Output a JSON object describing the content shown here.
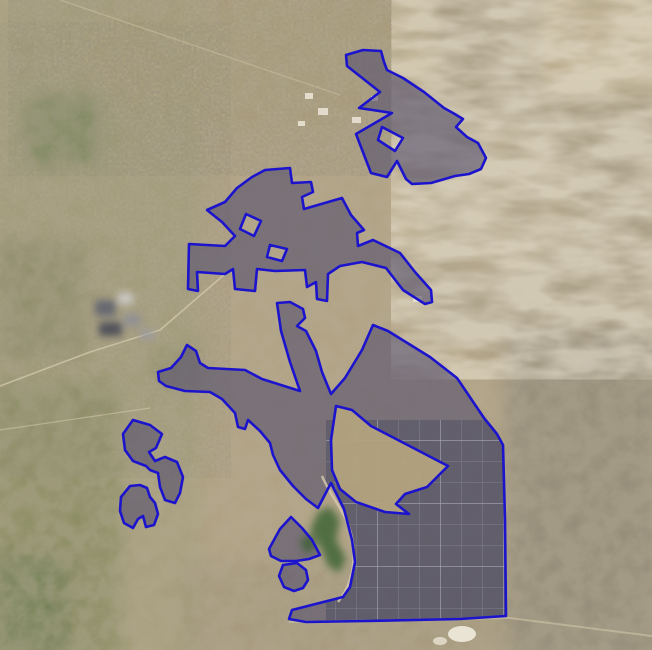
{
  "map": {
    "kind": "satellite-imagery-with-parcel-overlays",
    "canvas": {
      "width": 652,
      "height": 650
    },
    "overlay": {
      "stroke_color": "#1c13cd",
      "stroke_width": 2.6,
      "fill_color": "#57526e",
      "fill_opacity": 0.62,
      "cutout_fill_color": "#b3a37e",
      "panel_block_tint": "#2e3452",
      "panel_grid_line_color": "#b8bcd2",
      "polygons": [
        {
          "id": "site-north",
          "points": [
            [
              346,
              55
            ],
            [
              363,
              50
            ],
            [
              381,
              51
            ],
            [
              384,
              62
            ],
            [
              387,
              70
            ],
            [
              403,
              78
            ],
            [
              424,
              92
            ],
            [
              444,
              108
            ],
            [
              453,
              113
            ],
            [
              463,
              119
            ],
            [
              456,
              127
            ],
            [
              467,
              137
            ],
            [
              478,
              143
            ],
            [
              486,
              158
            ],
            [
              481,
              169
            ],
            [
              469,
              174
            ],
            [
              455,
              176
            ],
            [
              431,
              183
            ],
            [
              412,
              184
            ],
            [
              406,
              179
            ],
            [
              397,
              161
            ],
            [
              387,
              177
            ],
            [
              371,
              173
            ],
            [
              356,
              134
            ],
            [
              392,
              113
            ],
            [
              359,
              108
            ],
            [
              380,
              92
            ],
            [
              347,
              66
            ]
          ],
          "holes": [
            [
              [
                382,
                127
              ],
              [
                403,
                138
              ],
              [
                395,
                151
              ],
              [
                378,
                140
              ]
            ]
          ]
        },
        {
          "id": "site-middle",
          "points": [
            [
              252,
              177
            ],
            [
              265,
              170
            ],
            [
              290,
              168
            ],
            [
              292,
              183
            ],
            [
              311,
              182
            ],
            [
              313,
              192
            ],
            [
              302,
              197
            ],
            [
              304,
              209
            ],
            [
              342,
              198
            ],
            [
              351,
              215
            ],
            [
              364,
              230
            ],
            [
              357,
              233
            ],
            [
              358,
              246
            ],
            [
              373,
              240
            ],
            [
              400,
              253
            ],
            [
              415,
              272
            ],
            [
              431,
              290
            ],
            [
              432,
              302
            ],
            [
              425,
              304
            ],
            [
              403,
              290
            ],
            [
              386,
              268
            ],
            [
              362,
              262
            ],
            [
              340,
              266
            ],
            [
              328,
              274
            ],
            [
              327,
              301
            ],
            [
              317,
              299
            ],
            [
              316,
              282
            ],
            [
              307,
              287
            ],
            [
              305,
              270
            ],
            [
              275,
              271
            ],
            [
              257,
              269
            ],
            [
              255,
              291
            ],
            [
              235,
              289
            ],
            [
              233,
              269
            ],
            [
              225,
              274
            ],
            [
              197,
              272
            ],
            [
              198,
              291
            ],
            [
              188,
              289
            ],
            [
              189,
              244
            ],
            [
              225,
              246
            ],
            [
              235,
              236
            ],
            [
              222,
              222
            ],
            [
              207,
              210
            ],
            [
              225,
              202
            ],
            [
              237,
              188
            ]
          ],
          "holes": [
            [
              [
                246,
                214
              ],
              [
                261,
                221
              ],
              [
                254,
                236
              ],
              [
                240,
                229
              ]
            ],
            [
              [
                270,
                245
              ],
              [
                287,
                249
              ],
              [
                282,
                261
              ],
              [
                267,
                257
              ]
            ]
          ]
        },
        {
          "id": "site-main",
          "points": [
            [
              277,
              303
            ],
            [
              290,
              302
            ],
            [
              303,
              309
            ],
            [
              305,
              318
            ],
            [
              297,
              326
            ],
            [
              306,
              331
            ],
            [
              316,
              351
            ],
            [
              322,
              372
            ],
            [
              331,
              394
            ],
            [
              345,
              378
            ],
            [
              362,
              350
            ],
            [
              373,
              325
            ],
            [
              388,
              331
            ],
            [
              430,
              357
            ],
            [
              457,
              378
            ],
            [
              484,
              418
            ],
            [
              497,
              434
            ],
            [
              503,
              445
            ],
            [
              505,
              520
            ],
            [
              506,
              616
            ],
            [
              460,
              619
            ],
            [
              365,
              621
            ],
            [
              306,
              622
            ],
            [
              289,
              619
            ],
            [
              292,
              610
            ],
            [
              343,
              597
            ],
            [
              350,
              587
            ],
            [
              355,
              562
            ],
            [
              352,
              540
            ],
            [
              344,
              509
            ],
            [
              331,
              483
            ],
            [
              318,
              508
            ],
            [
              306,
              499
            ],
            [
              293,
              486
            ],
            [
              280,
              470
            ],
            [
              273,
              455
            ],
            [
              270,
              443
            ],
            [
              260,
              431
            ],
            [
              248,
              420
            ],
            [
              245,
              429
            ],
            [
              238,
              427
            ],
            [
              235,
              413
            ],
            [
              222,
              399
            ],
            [
              210,
              392
            ],
            [
              185,
              391
            ],
            [
              166,
              386
            ],
            [
              159,
              381
            ],
            [
              158,
              372
            ],
            [
              171,
              368
            ],
            [
              181,
              357
            ],
            [
              187,
              345
            ],
            [
              196,
              351
            ],
            [
              200,
              363
            ],
            [
              208,
              368
            ],
            [
              245,
              370
            ],
            [
              262,
              379
            ],
            [
              300,
              391
            ],
            [
              290,
              362
            ],
            [
              281,
              331
            ]
          ],
          "holes": []
        },
        {
          "id": "site-main-cutout",
          "cutout": true,
          "points": [
            [
              336,
              406
            ],
            [
              352,
              410
            ],
            [
              371,
              426
            ],
            [
              448,
              466
            ],
            [
              427,
              487
            ],
            [
              405,
              494
            ],
            [
              396,
              504
            ],
            [
              409,
              514
            ],
            [
              385,
              512
            ],
            [
              356,
              502
            ],
            [
              340,
              489
            ],
            [
              332,
              470
            ],
            [
              331,
              440
            ]
          ]
        },
        {
          "id": "site-west-upper",
          "points": [
            [
              133,
              420
            ],
            [
              150,
              425
            ],
            [
              162,
              434
            ],
            [
              156,
              448
            ],
            [
              149,
              452
            ],
            [
              155,
              461
            ],
            [
              165,
              457
            ],
            [
              177,
              462
            ],
            [
              183,
              477
            ],
            [
              180,
              493
            ],
            [
              175,
              503
            ],
            [
              165,
              500
            ],
            [
              160,
              487
            ],
            [
              158,
              473
            ],
            [
              150,
              470
            ],
            [
              146,
              466
            ],
            [
              133,
              461
            ],
            [
              125,
              450
            ],
            [
              123,
              434
            ]
          ]
        },
        {
          "id": "site-west-lower",
          "points": [
            [
              121,
              497
            ],
            [
              130,
              486
            ],
            [
              140,
              485
            ],
            [
              147,
              488
            ],
            [
              150,
              497
            ],
            [
              155,
              503
            ],
            [
              158,
              514
            ],
            [
              154,
              525
            ],
            [
              146,
              527
            ],
            [
              143,
              516
            ],
            [
              138,
              519
            ],
            [
              133,
              528
            ],
            [
              124,
              523
            ],
            [
              120,
              511
            ]
          ]
        },
        {
          "id": "site-south-triangle",
          "points": [
            [
              269,
              549
            ],
            [
              280,
              529
            ],
            [
              291,
              517
            ],
            [
              302,
              528
            ],
            [
              312,
              540
            ],
            [
              320,
              555
            ],
            [
              309,
              559
            ],
            [
              296,
              561
            ],
            [
              281,
              561
            ],
            [
              271,
              556
            ]
          ]
        },
        {
          "id": "site-south-small",
          "points": [
            [
              283,
              565
            ],
            [
              297,
              563
            ],
            [
              306,
              570
            ],
            [
              308,
              580
            ],
            [
              303,
              588
            ],
            [
              294,
              591
            ],
            [
              284,
              587
            ],
            [
              279,
              576
            ]
          ]
        }
      ]
    },
    "terrain": {
      "base_color": "#b2a283",
      "farmland_olive": "#7d7f58",
      "field_green": "#5d7a44",
      "bottomleft_green": "#75804f",
      "ridge_tan": "#a89d87",
      "plain_gray": "#8d8675",
      "pale_wash": "#c6b794",
      "vegetation_green": "#47683a",
      "road_color": "#d8cbae",
      "building_white": "#e9e3d4",
      "urban_gray": "#6b6e7a"
    }
  }
}
